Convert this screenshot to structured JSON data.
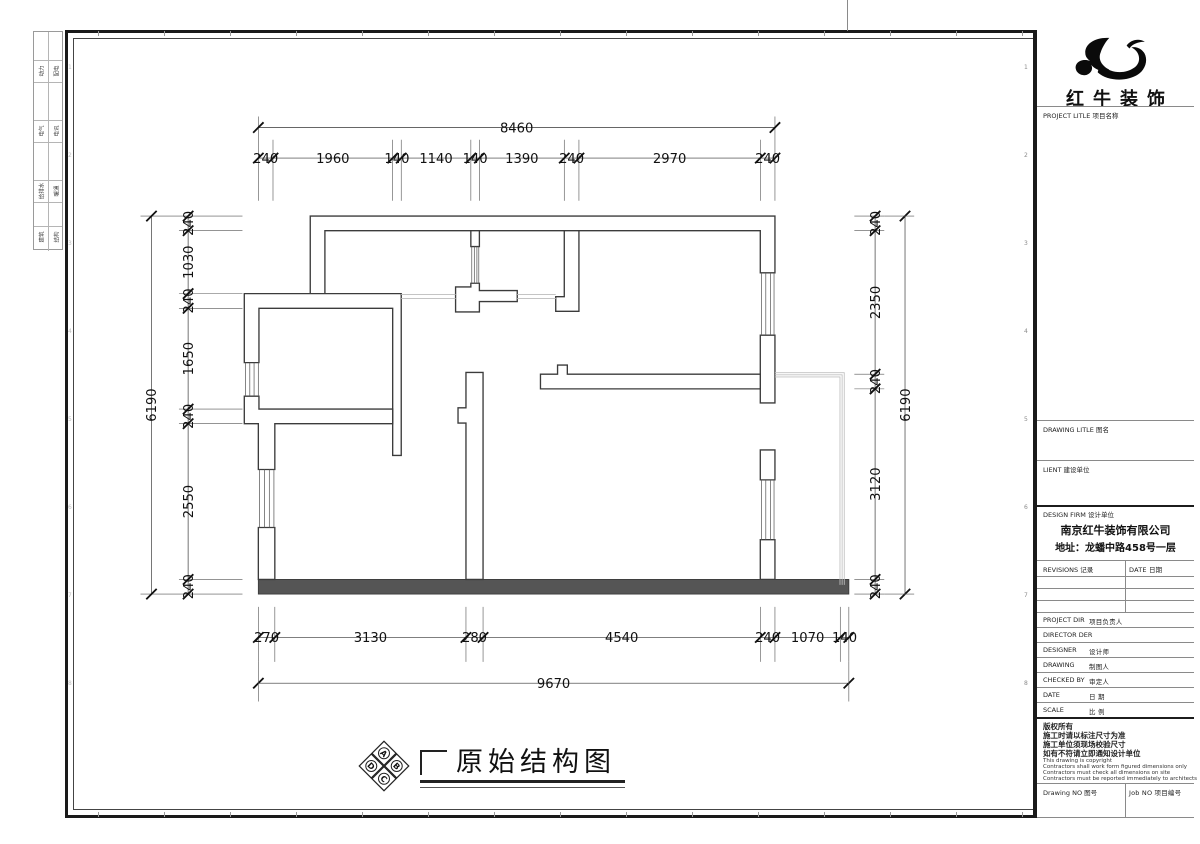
{
  "sheet": {
    "zone_numbers": [
      "1",
      "2",
      "3",
      "4",
      "5",
      "6",
      "7",
      "8"
    ]
  },
  "stamp_strip": {
    "rows": [
      [
        "动力",
        "配电"
      ],
      [
        "电气",
        "电讯"
      ],
      [
        "给排水",
        "暖通"
      ],
      [
        "建筑",
        "结构"
      ]
    ]
  },
  "logo": {
    "company_name": "红牛装饰"
  },
  "title_block": {
    "project_title_label": "PROJECT LITLE  项目名称",
    "drawing_title_label": "DRAWING LITLE  图名",
    "client_label": "LIENT  建设单位",
    "design_firm_label": "DESIGN FIRM  设计单位",
    "company_name": "南京红牛装饰有限公司",
    "company_address": "地址：龙蟠中路458号一层",
    "revisions_label": "REVISIONS  记录",
    "date_col_label": "DATE  日期",
    "rows": [
      {
        "en": "PROJECT DIR",
        "cn": "项目负责人"
      },
      {
        "en": "DIRECTOR DER",
        "cn": ""
      },
      {
        "en": "DESIGNER",
        "cn": "设计师"
      },
      {
        "en": "DRAWING",
        "cn": "制图人"
      },
      {
        "en": "CHECKED BY",
        "cn": "审定人"
      },
      {
        "en": "DATE",
        "cn": "日  期"
      },
      {
        "en": "SCALE",
        "cn": "比  例"
      }
    ],
    "copyright": {
      "cn_lines": [
        "版权所有",
        "施工时请以标注尺寸为准",
        "施工单位须现场校验尺寸",
        "如有不符请立即通知设计单位"
      ],
      "en_lines": [
        "This drawing is copyright",
        "Contractors shall work form figured dimensions only",
        "Contractors must check all dimensions on site",
        "Contractors must be reported immediately to architects"
      ]
    },
    "drawing_no_label": "Drawing NO  图号",
    "job_no_label": "Job NO  项目编号"
  },
  "drawing_label": {
    "title": "原始结构图",
    "diamond_letters": [
      "A",
      "B",
      "C",
      "D"
    ]
  },
  "dimensions": {
    "top": {
      "overall": "8460",
      "segments": [
        "240",
        "1960",
        "140",
        "1140",
        "140",
        "1390",
        "240",
        "2970",
        "240"
      ]
    },
    "left": {
      "overall": "6190",
      "segments": [
        "240",
        "1030",
        "240",
        "1650",
        "240",
        "2550",
        "240"
      ]
    },
    "right": {
      "overall": "6190",
      "segments": [
        "240",
        "2350",
        "240",
        "3120",
        "240"
      ]
    },
    "bottom": {
      "overall": "9670",
      "segments": [
        "270",
        "3130",
        "280",
        "4540",
        "240",
        "1070",
        "140"
      ]
    }
  }
}
